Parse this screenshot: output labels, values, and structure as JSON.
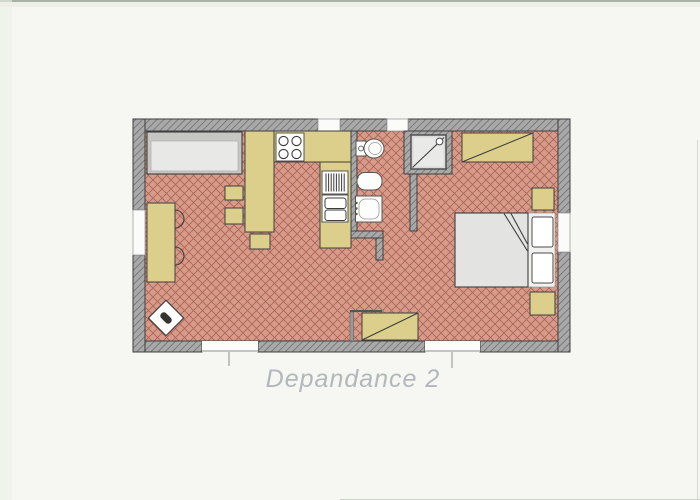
{
  "title": "Depandance 2",
  "colors": {
    "background": "#f6f7f2",
    "wall": "#a9a9a9",
    "wall_hatch": "#6f6f6f",
    "outline": "#3f3f3f",
    "floor": "#d69b8b",
    "floor_grid": "#a55a47",
    "furniture": "#dbcf8b",
    "fixture": "#fdfdfb",
    "sofa_body": "#e8e8e6",
    "sofa_back": "#c6c6c4",
    "bed_mattress": "#e3e3e1",
    "shower_tray": "#dadad8",
    "title_text": "#b3b7bb"
  },
  "plan_items": {
    "living_area": [
      "sofa-bed",
      "dining-table",
      "chair",
      "chair",
      "stool",
      "stool",
      "bar-stool",
      "corner-stove"
    ],
    "kitchen": [
      "counter-left",
      "counter-top",
      "cooktop",
      "counter-right",
      "dish-rack",
      "double-sink"
    ],
    "bathroom": [
      "toilet",
      "bidet",
      "washbasin",
      "shower"
    ],
    "bedroom": [
      "wardrobe",
      "double-bed",
      "pillow",
      "pillow",
      "nightstand",
      "nightstand"
    ],
    "hall": [
      "wardrobe",
      "shelf"
    ],
    "openings": [
      "entrance-door",
      "entrance-door",
      "window-left",
      "window-top-1",
      "window-top-2",
      "window-right"
    ]
  }
}
